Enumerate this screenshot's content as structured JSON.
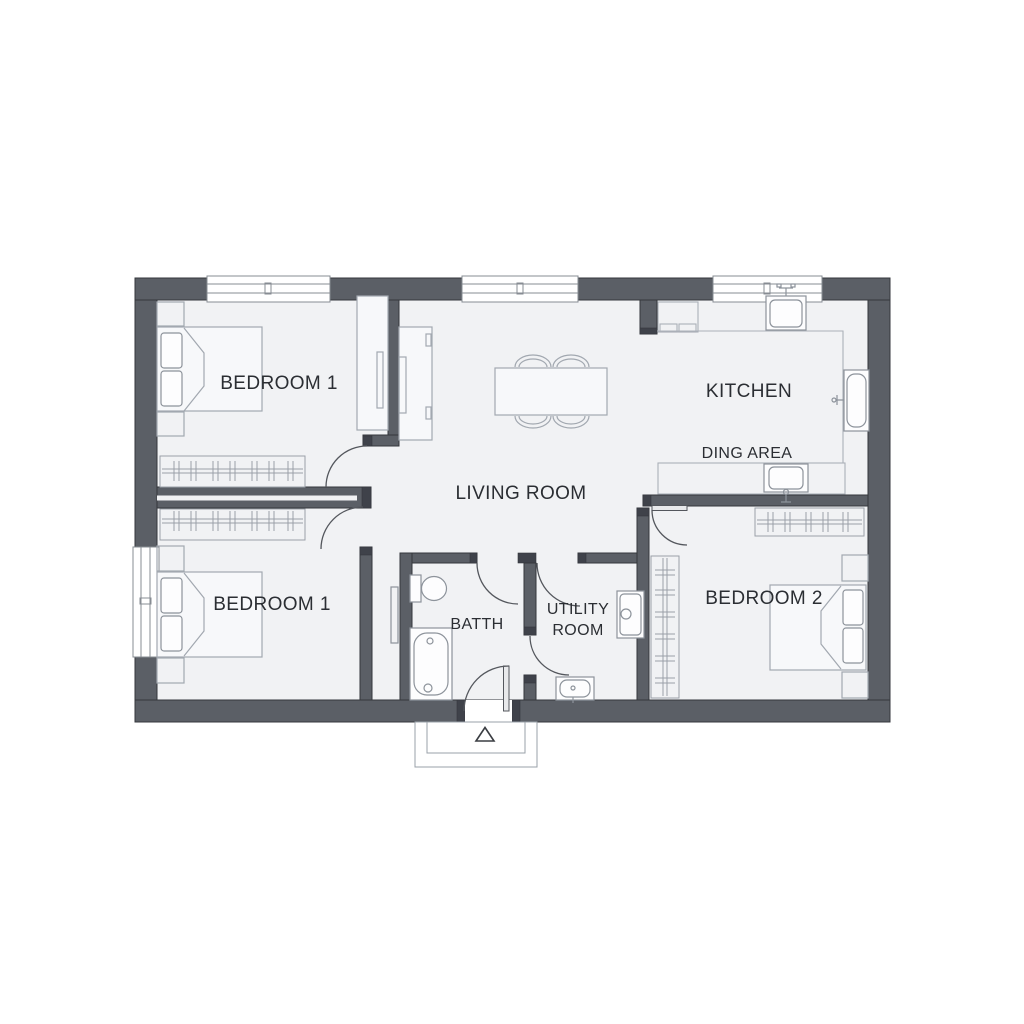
{
  "floor_plan": {
    "rooms": {
      "bedroom1_top": {
        "label": "BEDROOM 1"
      },
      "living_room": {
        "label": "LIVING ROOM"
      },
      "kitchen": {
        "label": "KITCHEN"
      },
      "dining_area": {
        "label": "DING AREA"
      },
      "bedroom1_bottom": {
        "label": "BEDROOM 1"
      },
      "bath": {
        "label": "BATTH"
      },
      "utility_room": {
        "label_line1": "UTILITY",
        "label_line2": "ROOM"
      },
      "bedroom2": {
        "label": "BEDROOM 2"
      }
    },
    "entry_marker": "triangle-up",
    "colors": {
      "background": "#ffffff",
      "wall": "#5b5f66",
      "wall_edge": "#34373c",
      "wall_cap": "#3f424a",
      "floor": "#f1f2f4",
      "furniture": "#a2a8b0",
      "fixture": "#8d939b",
      "window_frame": "#878c93",
      "door_arc": "#54575d",
      "label_text": "#2b2e33"
    }
  }
}
